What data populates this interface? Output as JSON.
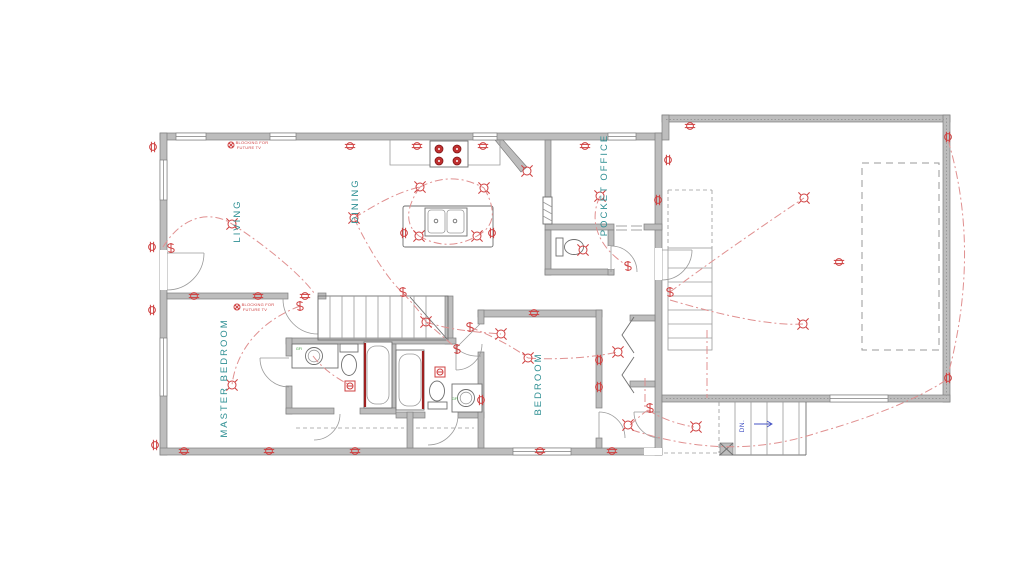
{
  "drawing": {
    "type": "electrical-floor-plan",
    "rooms": [
      {
        "id": "living",
        "label": "LIVING"
      },
      {
        "id": "dining",
        "label": "DINING"
      },
      {
        "id": "pocket_office",
        "label": "POCKET OFFICE"
      },
      {
        "id": "master_bedroom",
        "label": "MASTER BEDROOM"
      },
      {
        "id": "bedroom",
        "label": "BEDROOM"
      }
    ],
    "annotations": {
      "blocking_line1": "BLOCKING FOR",
      "blocking_line2": "FUTURE TV",
      "down": "DN.",
      "gfi": "GFI"
    },
    "icons": {
      "outlet": "duplex-outlet-icon",
      "light": "ceiling-light-icon",
      "switch": "switch-icon",
      "box": "boxed-outlet-icon"
    },
    "colors": {
      "paper": "#ffffff",
      "wall-fill": "#bdbdbd",
      "wall-stroke": "#7e7e7e",
      "line": "#9a9a9a",
      "line-dark": "#6f6f6f",
      "red": "#cf4040",
      "red-dark": "#9e2020",
      "wire": "#e09090",
      "teal": "#2e8f93",
      "blue": "#4553c4",
      "green": "#3f9a3f"
    }
  }
}
